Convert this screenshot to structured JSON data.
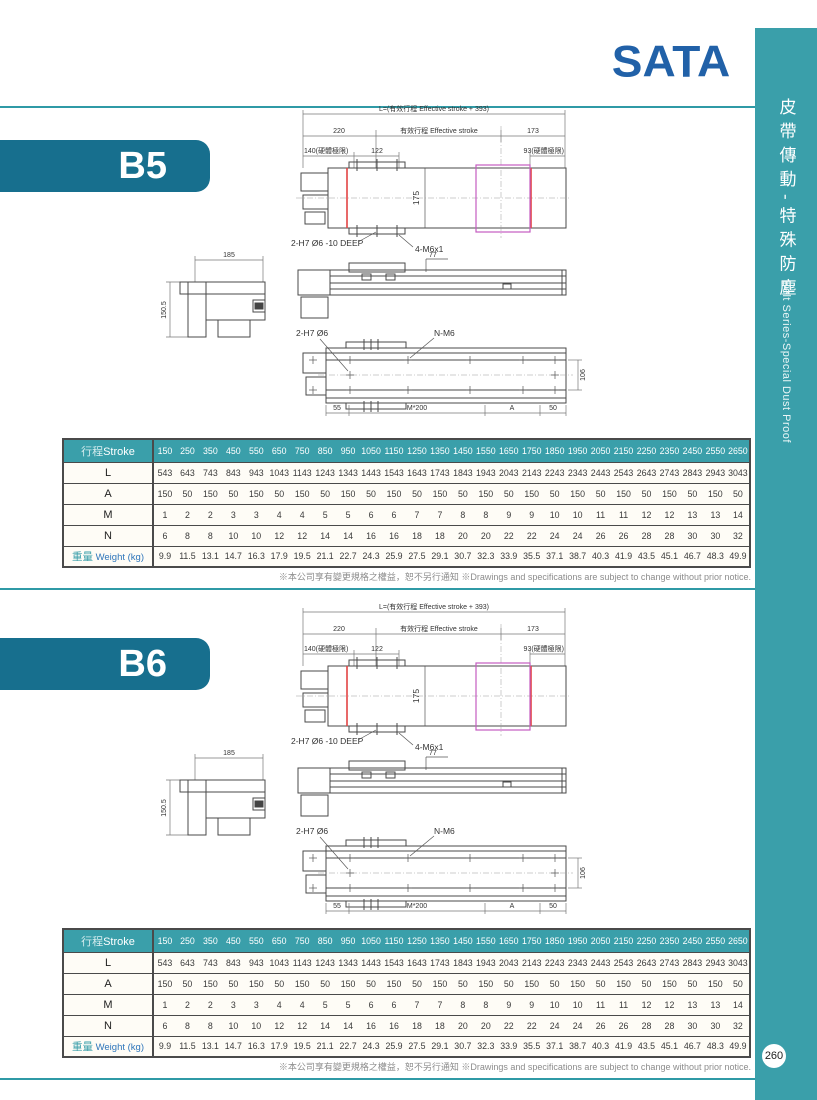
{
  "page": {
    "logo": "SATA",
    "page_number": "260",
    "note_zh": "※本公司享有變更規格之權益，恕不另行通知",
    "note_en": "※Drawings and specifications are subject to change without prior notice."
  },
  "sidebar": {
    "title_zh": "皮帶傳動-特殊防塵",
    "title_en": "Belt Series-Special Dust Proof",
    "color": "#3a9faa"
  },
  "drawing": {
    "dim_L": "L=(有效行程 Effective stroke + 393)",
    "dim_220": "220",
    "dim_effective": "有效行程 Effective stroke",
    "dim_173": "173",
    "dim_140": "140(硬體極限)",
    "dim_122": "122",
    "dim_93": "93(硬體極限)",
    "dim_175": "175",
    "hole_top": "2-H7 Ø6 -10 DEEP",
    "thread_top": "4-M6x1",
    "dim_77": "77",
    "dim_185": "185",
    "dim_150_5": "150.5",
    "hole_bottom": "2-H7 Ø6",
    "thread_bottom": "N-M6",
    "dim_106": "106",
    "dim_55": "55",
    "dim_M200": "M*200",
    "dim_A": "A",
    "dim_50": "50"
  },
  "b5": {
    "banner": "B5",
    "table": {
      "header": {
        "zh": "行程",
        "en": "Stroke"
      },
      "strokes": [
        150,
        250,
        350,
        450,
        550,
        650,
        750,
        850,
        950,
        1050,
        1150,
        1250,
        1350,
        1450,
        1550,
        1650,
        1750,
        1850,
        1950,
        2050,
        2150,
        2250,
        2350,
        2450,
        2550,
        2650
      ],
      "rows": [
        {
          "label": "L",
          "values": [
            543,
            643,
            743,
            843,
            943,
            1043,
            1143,
            1243,
            1343,
            1443,
            1543,
            1643,
            1743,
            1843,
            1943,
            2043,
            2143,
            2243,
            2343,
            2443,
            2543,
            2643,
            2743,
            2843,
            2943,
            3043
          ]
        },
        {
          "label": "A",
          "values": [
            150,
            50,
            150,
            50,
            150,
            50,
            150,
            50,
            150,
            50,
            150,
            50,
            150,
            50,
            150,
            50,
            150,
            50,
            150,
            50,
            150,
            50,
            150,
            50,
            150,
            50
          ]
        },
        {
          "label": "M",
          "values": [
            1,
            2,
            2,
            3,
            3,
            4,
            4,
            5,
            5,
            6,
            6,
            7,
            7,
            8,
            8,
            9,
            9,
            10,
            10,
            11,
            11,
            12,
            12,
            13,
            13,
            14
          ]
        },
        {
          "label": "N",
          "values": [
            6,
            8,
            8,
            10,
            10,
            12,
            12,
            14,
            14,
            16,
            16,
            18,
            18,
            20,
            20,
            22,
            22,
            24,
            24,
            26,
            26,
            28,
            28,
            30,
            30,
            32
          ]
        },
        {
          "label_zh": "重量",
          "label_en": "Weight (kg)",
          "values": [
            9.9,
            11.5,
            13.1,
            14.7,
            16.3,
            17.9,
            19.5,
            21.1,
            22.7,
            24.3,
            25.9,
            27.5,
            29.1,
            30.7,
            32.3,
            33.9,
            35.5,
            37.1,
            38.7,
            40.3,
            41.9,
            43.5,
            45.1,
            46.7,
            48.3,
            49.9
          ]
        }
      ]
    }
  },
  "b6": {
    "banner": "B6",
    "table": {
      "header": {
        "zh": "行程",
        "en": "Stroke"
      },
      "strokes": [
        150,
        250,
        350,
        450,
        550,
        650,
        750,
        850,
        950,
        1050,
        1150,
        1250,
        1350,
        1450,
        1550,
        1650,
        1750,
        1850,
        1950,
        2050,
        2150,
        2250,
        2350,
        2450,
        2550,
        2650
      ],
      "rows": [
        {
          "label": "L",
          "values": [
            543,
            643,
            743,
            843,
            943,
            1043,
            1143,
            1243,
            1343,
            1443,
            1543,
            1643,
            1743,
            1843,
            1943,
            2043,
            2143,
            2243,
            2343,
            2443,
            2543,
            2643,
            2743,
            2843,
            2943,
            3043
          ]
        },
        {
          "label": "A",
          "values": [
            150,
            50,
            150,
            50,
            150,
            50,
            150,
            50,
            150,
            50,
            150,
            50,
            150,
            50,
            150,
            50,
            150,
            50,
            150,
            50,
            150,
            50,
            150,
            50,
            150,
            50
          ]
        },
        {
          "label": "M",
          "values": [
            1,
            2,
            2,
            3,
            3,
            4,
            4,
            5,
            5,
            6,
            6,
            7,
            7,
            8,
            8,
            9,
            9,
            10,
            10,
            11,
            11,
            12,
            12,
            13,
            13,
            14
          ]
        },
        {
          "label": "N",
          "values": [
            6,
            8,
            8,
            10,
            10,
            12,
            12,
            14,
            14,
            16,
            16,
            18,
            18,
            20,
            20,
            22,
            22,
            24,
            24,
            26,
            26,
            28,
            28,
            30,
            30,
            32
          ]
        },
        {
          "label_zh": "重量",
          "label_en": "Weight (kg)",
          "values": [
            9.9,
            11.5,
            13.1,
            14.7,
            16.3,
            17.9,
            19.5,
            21.1,
            22.7,
            24.3,
            25.9,
            27.5,
            29.1,
            30.7,
            32.3,
            33.9,
            35.5,
            37.1,
            38.7,
            40.3,
            41.9,
            43.5,
            45.1,
            46.7,
            48.3,
            49.9
          ]
        }
      ]
    }
  }
}
